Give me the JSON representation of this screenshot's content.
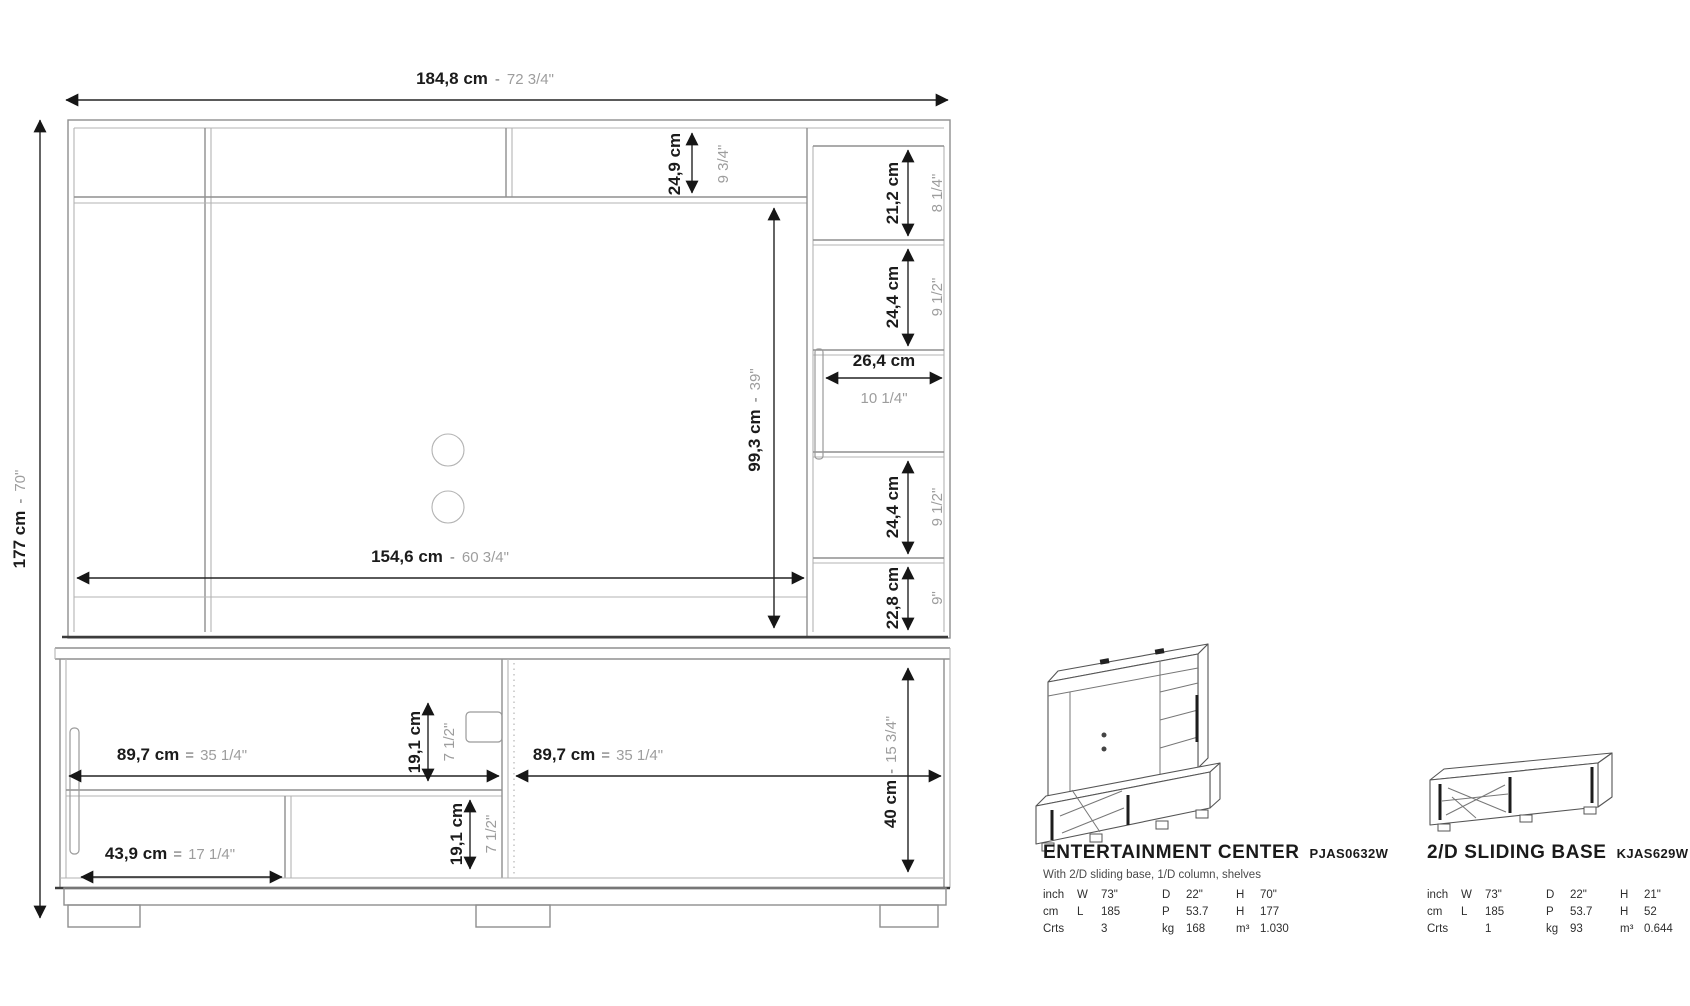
{
  "palette": {
    "background": "#ffffff",
    "dimension_line": "#232323",
    "structure_line": "#8f8f8f",
    "cm_text": "#1b1b1b",
    "inch_text": "#9d9d9d"
  },
  "front_view": {
    "total_width": {
      "cm": "184,8 cm",
      "sep": "-",
      "in": "72 3/4\""
    },
    "total_height": {
      "cm": "177 cm",
      "sep": "-",
      "in": "70\""
    },
    "top_shelf_height": {
      "cm": "24,9 cm",
      "in": "9 3/4\""
    },
    "column_s1": {
      "cm": "21,2 cm",
      "in": "8 1/4\""
    },
    "column_s2": {
      "cm": "24,4 cm",
      "in": "9 1/2\""
    },
    "niche_width": {
      "cm": "26,4 cm",
      "in": "10 1/4\""
    },
    "column_s3": {
      "cm": "24,4 cm",
      "in": "9 1/2\""
    },
    "column_s4": {
      "cm": "22,8 cm",
      "in": "9\""
    },
    "tv_height": {
      "cm": "99,3 cm",
      "sep": "-",
      "in": "39\""
    },
    "tv_width": {
      "cm": "154,6 cm",
      "sep": "-",
      "in": "60 3/4\""
    },
    "base_left_width": {
      "cm": "89,7 cm",
      "sep": "=",
      "in": "35 1/4\""
    },
    "base_right_width": {
      "cm": "89,7 cm",
      "sep": "=",
      "in": "35 1/4\""
    },
    "base_upper_height": {
      "cm": "19,1 cm",
      "in": "7 1/2\""
    },
    "base_lower_height": {
      "cm": "19,1 cm",
      "in": "7 1/2\""
    },
    "drawer_width": {
      "cm": "43,9 cm",
      "sep": "=",
      "in": "17 1/4\""
    },
    "base_opening_height": {
      "cm": "40 cm",
      "sep": "-",
      "in": "15 3/4\""
    }
  },
  "products": [
    {
      "title": "ENTERTAINMENT CENTER",
      "sku": "PJAS0632W",
      "subtitle": "With 2/D sliding base, 1/D column, shelves",
      "specs": [
        {
          "label": "inch",
          "cols": [
            {
              "u": "W",
              "v": "73\""
            },
            {
              "u": "D",
              "v": "22\""
            },
            {
              "u": "H",
              "v": "70\""
            }
          ]
        },
        {
          "label": "cm",
          "cols": [
            {
              "u": "L",
              "v": "185"
            },
            {
              "u": "P",
              "v": "53.7"
            },
            {
              "u": "H",
              "v": "177"
            }
          ]
        },
        {
          "label": "Crts",
          "cols": [
            {
              "u": "",
              "v": "3"
            },
            {
              "u": "kg",
              "v": "168"
            },
            {
              "u": "m³",
              "v": "1.030"
            }
          ]
        }
      ]
    },
    {
      "title": "2/D SLIDING BASE",
      "sku": "KJAS629W",
      "subtitle": "",
      "specs": [
        {
          "label": "inch",
          "cols": [
            {
              "u": "W",
              "v": "73\""
            },
            {
              "u": "D",
              "v": "22\""
            },
            {
              "u": "H",
              "v": "21\""
            }
          ]
        },
        {
          "label": "cm",
          "cols": [
            {
              "u": "L",
              "v": "185"
            },
            {
              "u": "P",
              "v": "53.7"
            },
            {
              "u": "H",
              "v": "52"
            }
          ]
        },
        {
          "label": "Crts",
          "cols": [
            {
              "u": "",
              "v": "1"
            },
            {
              "u": "kg",
              "v": "93"
            },
            {
              "u": "m³",
              "v": "0.644"
            }
          ]
        }
      ]
    }
  ]
}
